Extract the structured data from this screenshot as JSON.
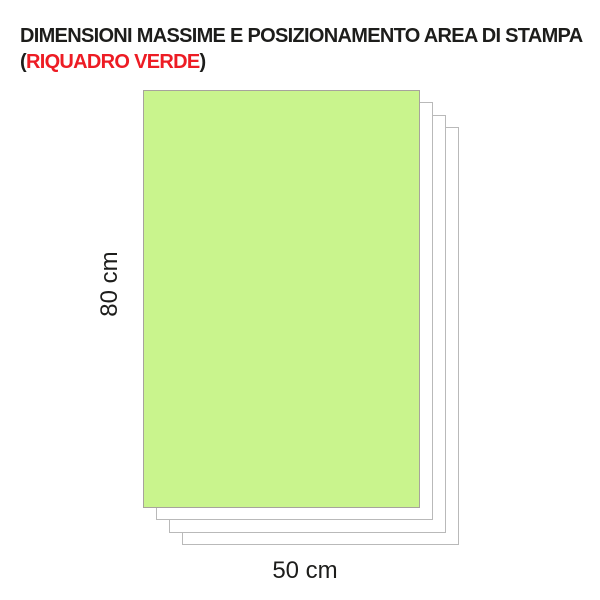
{
  "title": {
    "line1": "DIMENSIONI MASSIME E POSIZIONAMENTO AREA DI STAMPA",
    "line2_prefix": "(",
    "line2_highlight": "RIQUADRO VERDE",
    "line2_suffix": ")"
  },
  "diagram": {
    "height_label": "80 cm",
    "width_label": "50 cm",
    "sheet_count": 4
  },
  "colors": {
    "print_area_green": "#c9f48d",
    "highlight_red": "#ed1c24",
    "sheet_border": "#b9b9b9",
    "green_border": "#a7a39c",
    "text": "#1d1d1b"
  }
}
